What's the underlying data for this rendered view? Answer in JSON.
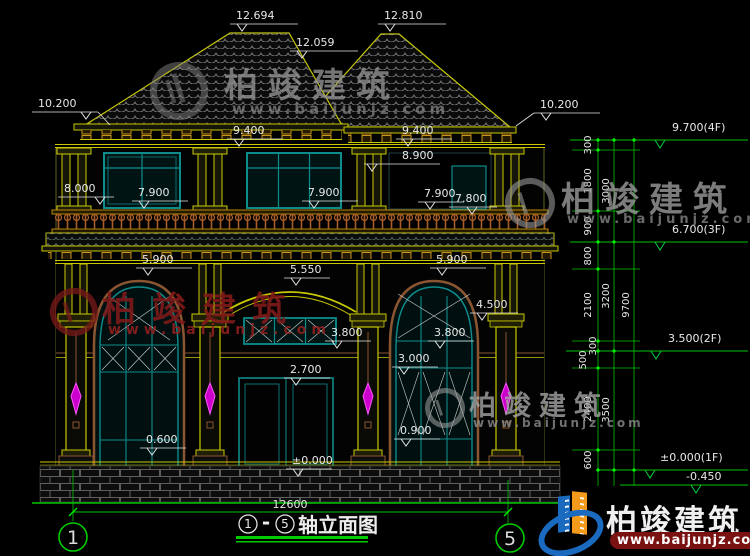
{
  "drawing_title": {
    "axis_start": "1",
    "separator": "-",
    "axis_end": "5",
    "name": "轴立面图"
  },
  "axis_bubbles": {
    "left": "1",
    "right": "5"
  },
  "dims": {
    "total_width": "12600"
  },
  "levels": {
    "ridge_left": "12.694",
    "ridge_right": "12.810",
    "valley": "12.059",
    "eave_left": "10.200",
    "eave_right": "10.200",
    "eave_board_left": "9.400",
    "eave_board_right": "9.400",
    "f2_opening": "8.900",
    "f2_window_left": "8.000",
    "f2_sill_a": "7.900",
    "f2_sill_b": "7.900",
    "f2_sill_c": "7.900",
    "f2_floor": "7.800",
    "arch_left": "5.900",
    "arch_entry": "5.550",
    "arch_right": "5.900",
    "capital_right": "4.500",
    "transom_entry": "3.800",
    "transom_right": "3.800",
    "transom_right_low": "3.000",
    "door_head": "2.700",
    "sill_right_low": "0.900",
    "sill_left_low": "0.600",
    "ground": "±0.000"
  },
  "right_markers": {
    "f4": "9.700(4F)",
    "f3": "6.700(3F)",
    "f2": "3.500(2F)",
    "f1": "±0.000(1F)",
    "below": "-0.450"
  },
  "dim_chain_inner": [
    "300",
    "1800",
    "900",
    "800",
    "2100",
    "300",
    "500",
    "2400",
    "600"
  ],
  "dim_chain_mid": [
    "3000",
    "3200",
    "3500"
  ],
  "dim_chain_outer": [
    "9700"
  ],
  "watermark": {
    "brand": "柏竣建筑",
    "url": "www.baijunjz.com"
  },
  "colors": {
    "background": "#000000",
    "dim_green": "#00c400",
    "tick_green": "#00ee00",
    "line_yellow": "#c8c800",
    "window_teal": "#0e8c8c",
    "railing_brown": "#a65c28",
    "lamp_magenta": "#cc00cc",
    "text_white": "#e8e8e8",
    "roof_gray": "#8f8f8f",
    "brand_blue": "#1a6bc0",
    "brand_orange": "#f49a1a",
    "watermark_red": "#7a1a1a"
  }
}
